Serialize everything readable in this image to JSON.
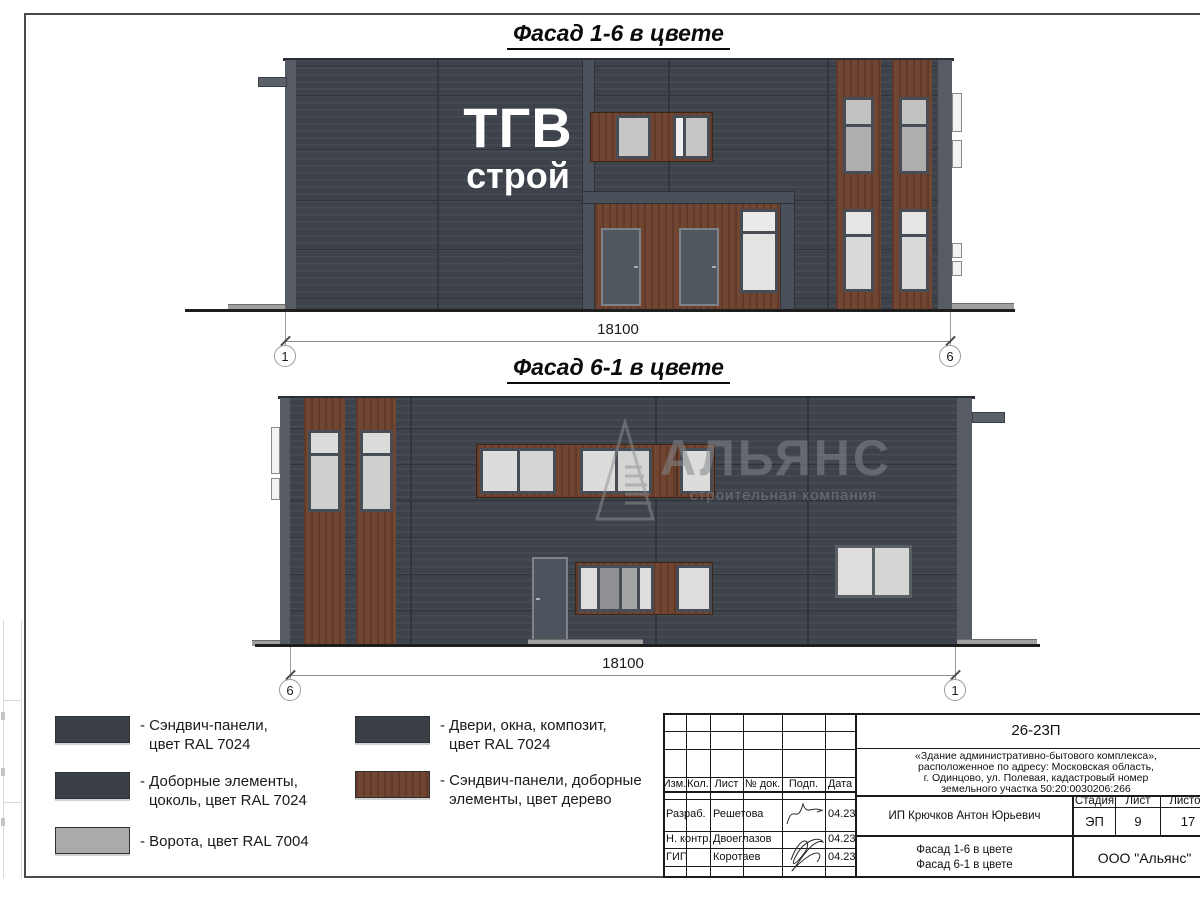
{
  "facade1": {
    "title": "Фасад 1-6 в цвете",
    "logo_line1": "ТГВ",
    "logo_line2": "строй",
    "dimension": "18100",
    "axis_left": "1",
    "axis_right": "6"
  },
  "facade2": {
    "title": "Фасад 6-1 в цвете",
    "dimension": "18100",
    "axis_left": "6",
    "axis_right": "1",
    "watermark_name": "АЛЬЯНС",
    "watermark_tagline": "строительная компания"
  },
  "legend": {
    "items": [
      {
        "swatch_color": "#3b4047",
        "line1": "- Сэндвич-панели,",
        "line2": "цвет RAL 7024"
      },
      {
        "swatch_color": "#3b4047",
        "line1": "- Доборные элементы,",
        "line2": "цоколь, цвет RAL 7024"
      },
      {
        "swatch_color": "#a8aba8",
        "line1": "- Ворота, цвет RAL 7004",
        "line2": ""
      },
      {
        "swatch_color": "#3b4047",
        "line1": "- Двери, окна, композит,",
        "line2": "цвет RAL 7024"
      },
      {
        "swatch_color": "#6f4330",
        "line1": "- Сэндвич-панели, доборные",
        "line2": "элементы, цвет дерево"
      }
    ]
  },
  "titleblock": {
    "doc_number": "26-23П",
    "description_line1": "«Здание административно-бытового комплекса»,",
    "description_line2": "расположенное по адресу: Московская область,",
    "description_line3": "г. Одинцово, ул. Полевая, кадастровый номер",
    "description_line4": "земельного участка 50:20:0030206:266",
    "col_izm": "Изм.",
    "col_kol": "Кол.",
    "col_list": "Лист",
    "col_doc": "№ док.",
    "col_podp": "Подп.",
    "col_data": "Дата",
    "rows": [
      {
        "role": "Разраб.",
        "name": "Решетова",
        "date": "04.23"
      },
      {
        "role": "Н. контр.",
        "name": "Двоеглазов",
        "date": "04.23"
      },
      {
        "role": "ГИП",
        "name": "Коротаев",
        "date": "04.23"
      }
    ],
    "client": "ИП Крючков Антон Юрьевич",
    "stage_label": "Стадия",
    "sheet_label": "Лист",
    "sheets_label": "Листов",
    "stage": "ЭП",
    "sheet": "9",
    "sheets": "17",
    "subject_line1": "Фасад 1-6 в цвете",
    "subject_line2": "Фасад 6-1 в цвете",
    "org": "ООО \"Альянс\""
  },
  "colors": {
    "wall_ral7024": "#3e434b",
    "wood": "#714430",
    "trim": "#575c64",
    "door": "#51575f",
    "gate_ral7004": "#a8aba8",
    "glass_light": "#dedddb",
    "glass_mid": "#c6c6c4",
    "glass_dark": "#aeafad"
  }
}
